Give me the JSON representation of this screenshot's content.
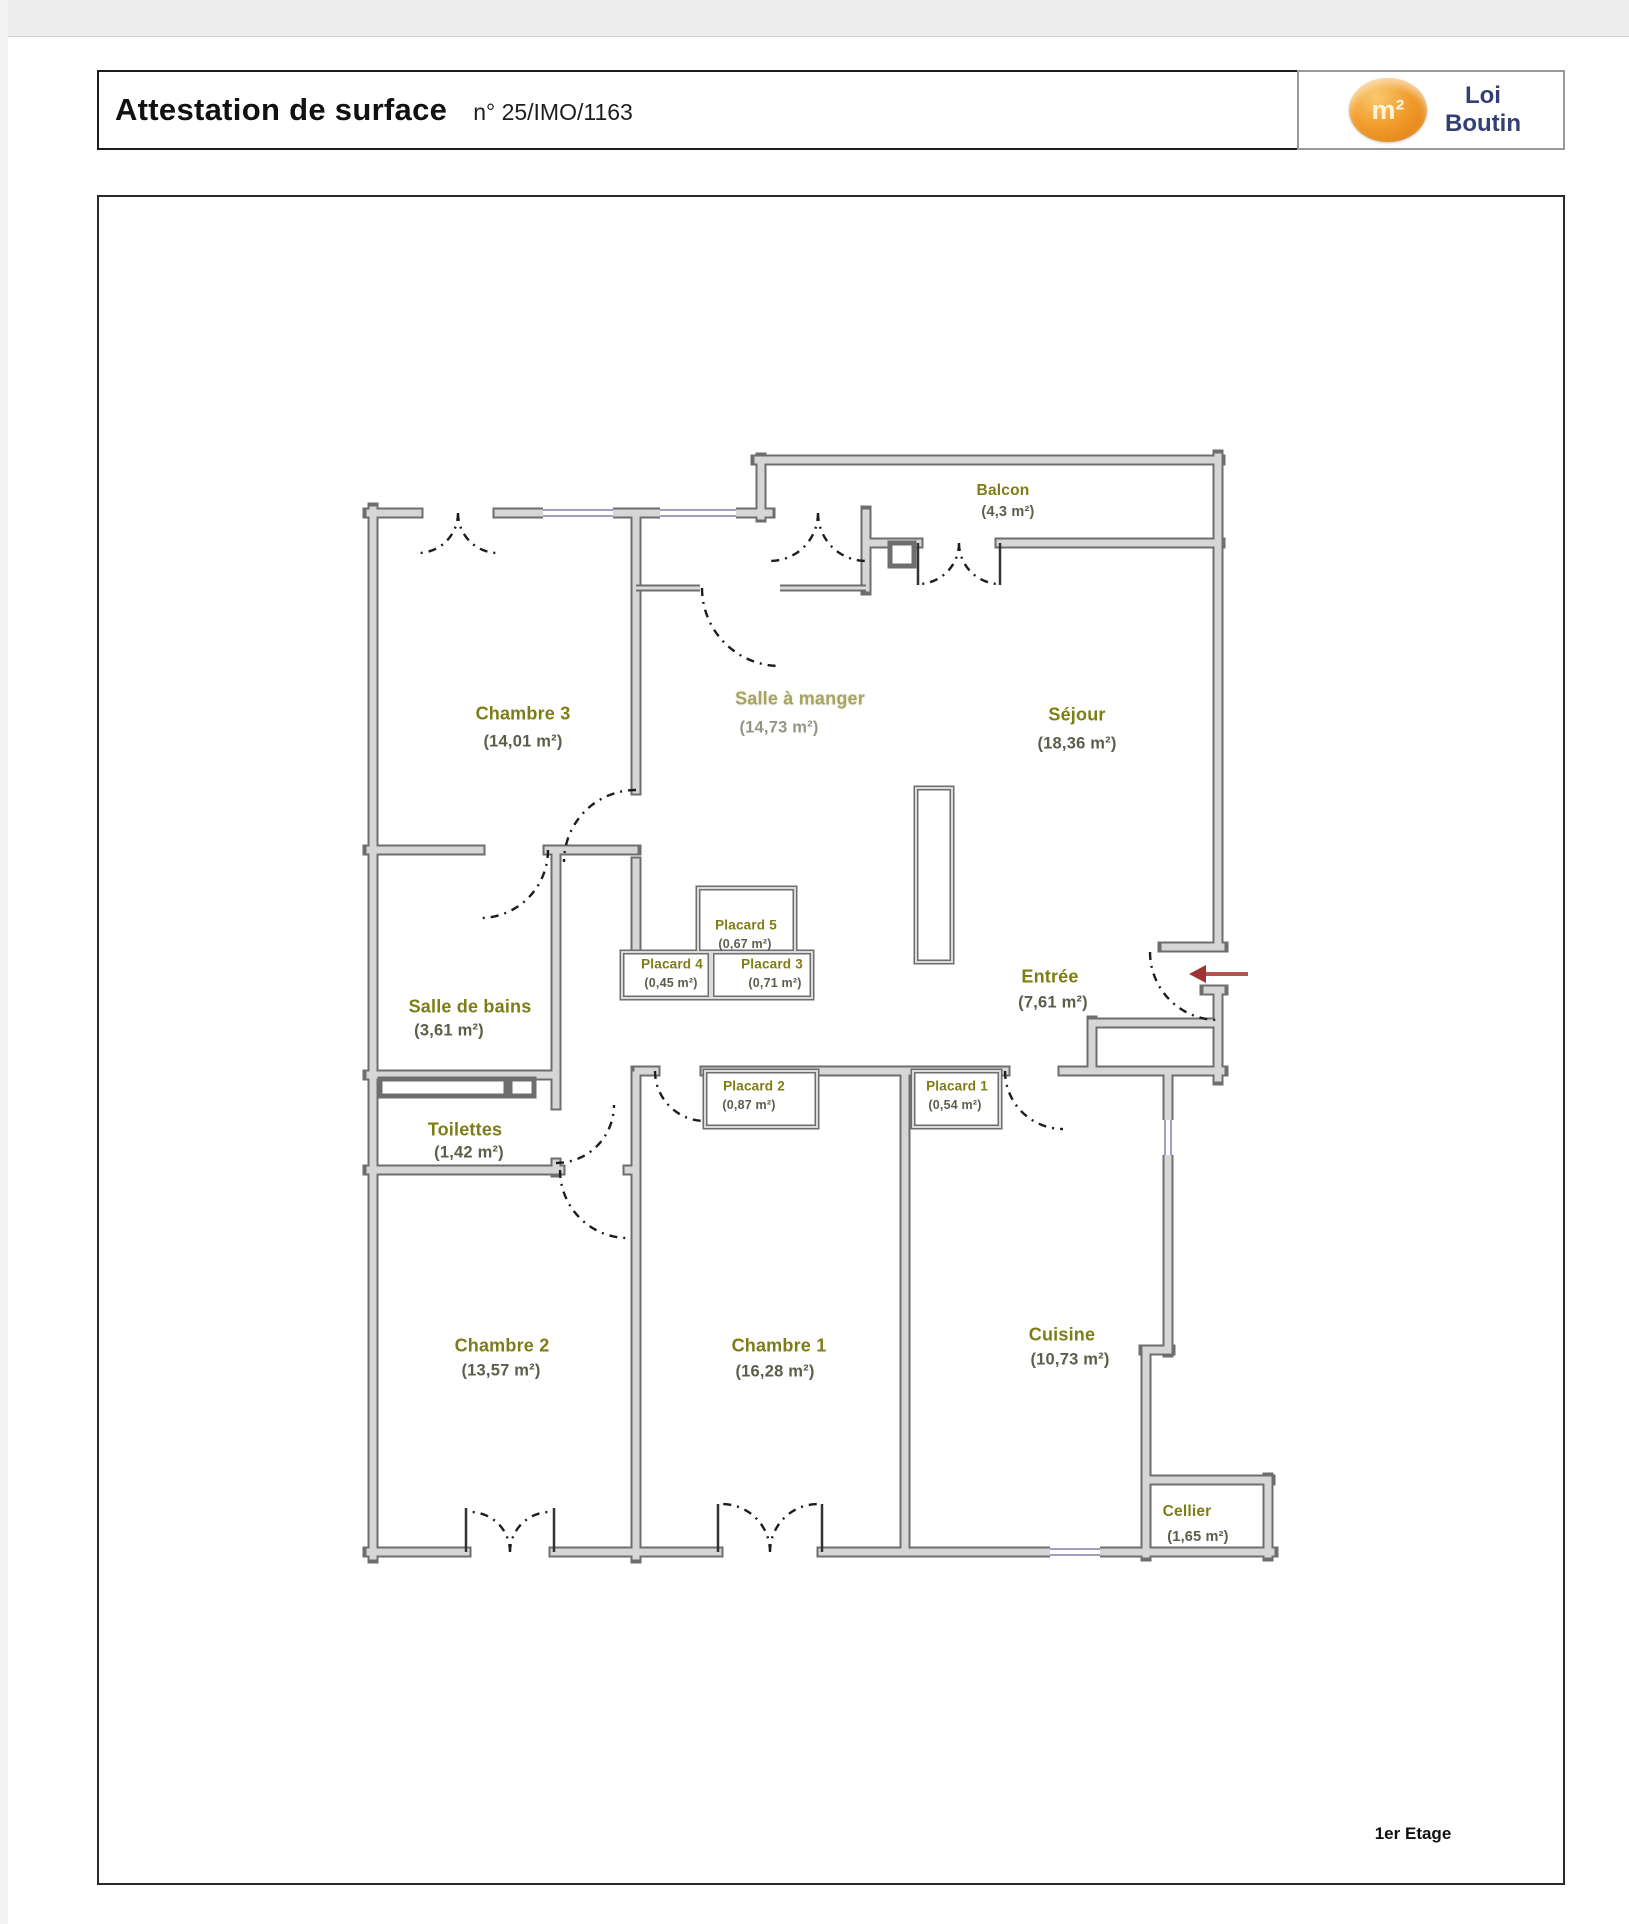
{
  "header": {
    "title": "Attestation de surface",
    "doc_number": "n° 25/IMO/1163",
    "logo": {
      "symbol": "m²",
      "name_line1": "Loi",
      "name_line2": "Boutin"
    }
  },
  "footer": {
    "floor_label": "1er Etage"
  },
  "colors": {
    "room_name": "#7d7d15",
    "room_area": "#5d5d4c",
    "wall_dark": "#6e6e6e",
    "wall_light": "#d6d6d6",
    "window": "#9f9fc4",
    "entry_arrow": "#b04a42",
    "logo_orange": "#e8821e",
    "logo_navy": "#343f73"
  },
  "rooms": [
    {
      "id": "balcon",
      "name": "Balcon",
      "area": "(4,3 m²)"
    },
    {
      "id": "chambre3",
      "name": "Chambre 3",
      "area": "(14,01 m²)"
    },
    {
      "id": "salle-a-manger",
      "name": "Salle à manger",
      "area": "(14,73 m²)"
    },
    {
      "id": "sejour",
      "name": "Séjour",
      "area": "(18,36 m²)"
    },
    {
      "id": "salle-de-bains",
      "name": "Salle de bains",
      "area": "(3,61 m²)"
    },
    {
      "id": "placard5",
      "name": "Placard 5",
      "area": "(0,67 m²)"
    },
    {
      "id": "placard4",
      "name": "Placard 4",
      "area": "(0,45 m²)"
    },
    {
      "id": "placard3",
      "name": "Placard 3",
      "area": "(0,71 m²)"
    },
    {
      "id": "entree",
      "name": "Entrée",
      "area": "(7,61 m²)"
    },
    {
      "id": "placard2",
      "name": "Placard 2",
      "area": "(0,87 m²)"
    },
    {
      "id": "placard1",
      "name": "Placard 1",
      "area": "(0,54 m²)"
    },
    {
      "id": "toilettes",
      "name": "Toilettes",
      "area": "(1,42 m²)"
    },
    {
      "id": "chambre2",
      "name": "Chambre 2",
      "area": "(13,57 m²)"
    },
    {
      "id": "chambre1",
      "name": "Chambre 1",
      "area": "(16,28 m²)"
    },
    {
      "id": "cuisine",
      "name": "Cuisine",
      "area": "(10,73 m²)"
    },
    {
      "id": "cellier",
      "name": "Cellier",
      "area": "(1,65 m²)"
    }
  ]
}
